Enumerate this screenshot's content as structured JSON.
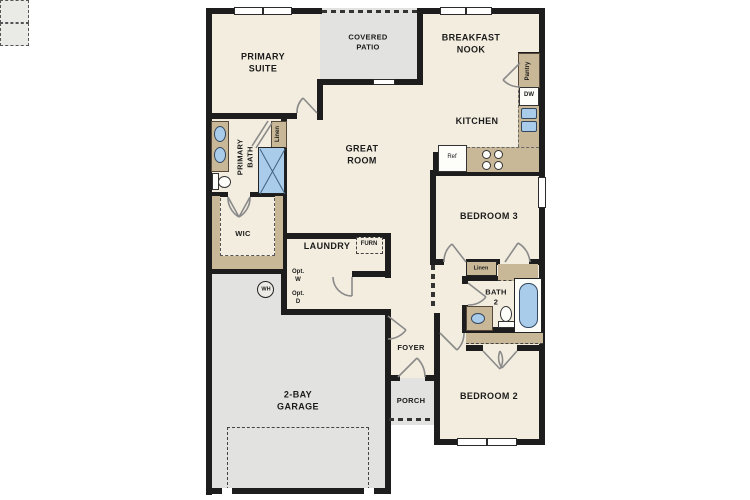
{
  "plan_type": "single-story residential floor plan",
  "rooms": {
    "primary_suite": {
      "line1": "PRIMARY",
      "line2": "SUITE"
    },
    "covered_patio": {
      "line1": "COVERED",
      "line2": "PATIO"
    },
    "breakfast_nook": {
      "line1": "BREAKFAST",
      "line2": "NOOK"
    },
    "kitchen": {
      "label": "KITCHEN"
    },
    "great_room": {
      "line1": "GREAT",
      "line2": "ROOM"
    },
    "primary_bath": {
      "line1": "PRIMARY",
      "line2": "BATH"
    },
    "walk_in_closet": {
      "label": "WIC"
    },
    "laundry": {
      "label": "LAUNDRY"
    },
    "bedroom_3": {
      "label": "BEDROOM 3"
    },
    "bath_2": {
      "line1": "BATH",
      "line2": "2"
    },
    "foyer": {
      "label": "FOYER"
    },
    "porch": {
      "label": "PORCH"
    },
    "bedroom_2": {
      "label": "BEDROOM 2"
    },
    "garage": {
      "line1": "2-BAY",
      "line2": "GARAGE"
    }
  },
  "fixtures": {
    "pantry": "Pantry",
    "dishwasher": "DW",
    "refrigerator": "Ref",
    "furnace": "FURN",
    "optional_washer": {
      "line1": "Opt.",
      "line2": "W"
    },
    "optional_dryer": {
      "line1": "Opt.",
      "line2": "D"
    },
    "water_heater": "WH",
    "linen_primary": "Linen",
    "linen_hall": "Linen"
  },
  "colors": {
    "floor": "#F3EDDF",
    "outdoor_concrete": "#E2E2E0",
    "wall": "#1D1D1D",
    "casework_tan": "#C9B897",
    "fixture_blue": "#A9CCEA",
    "background": "#FFFFFF"
  }
}
